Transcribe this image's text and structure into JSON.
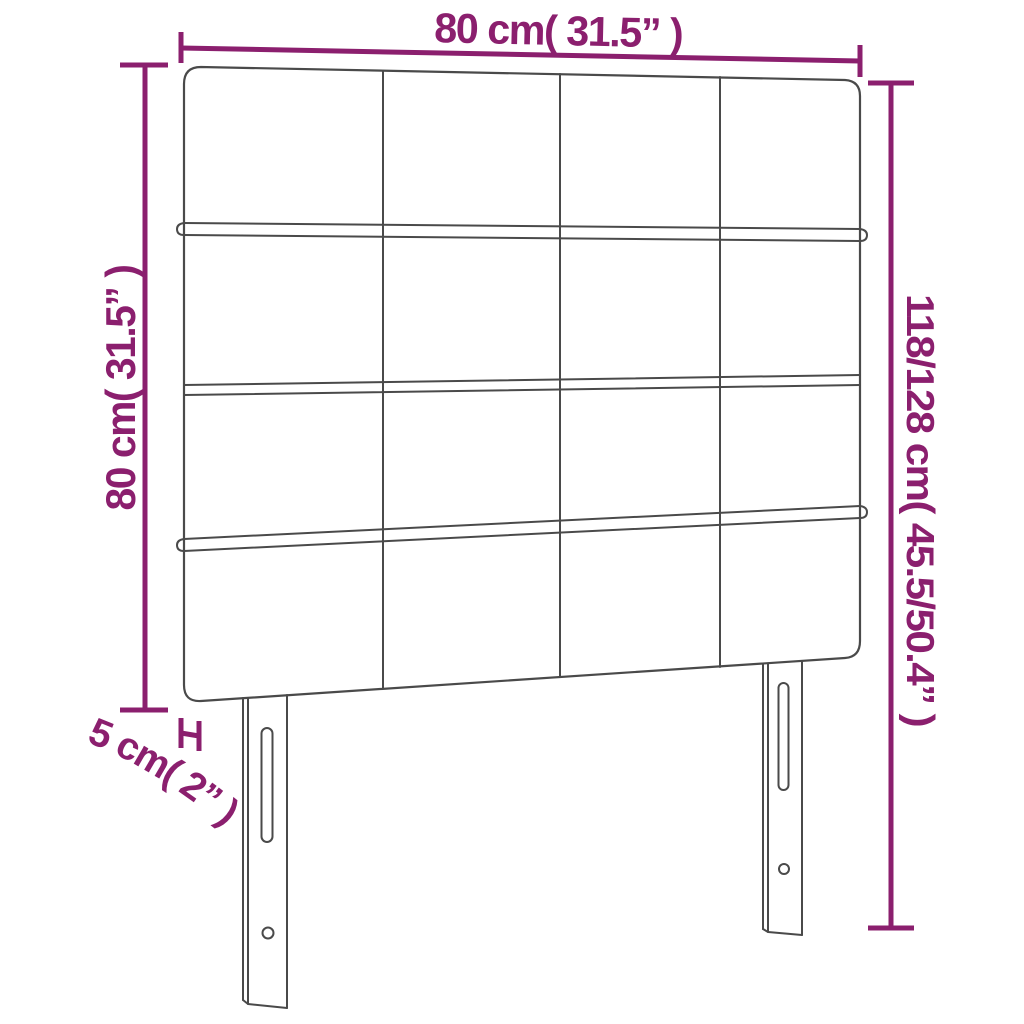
{
  "page": {
    "background": "#ffffff",
    "title": "Headboard dimension diagram"
  },
  "colors": {
    "dimension": "#8B1F6E",
    "outline": "#4A4A4A"
  },
  "product": {
    "type": "upholstered tufted headboard with legs",
    "panel_grid": {
      "rows": 4,
      "columns": 4
    },
    "legs_count": 2,
    "leg_features": [
      "height-adjustment-slot",
      "screw-hole"
    ]
  },
  "dimensions": {
    "width": {
      "label": "80 cm( 31.5” )"
    },
    "headboard_height": {
      "label": "80 cm( 31.5” )"
    },
    "total_height": {
      "label": "118/128 cm( 45.5/50.4” )"
    },
    "thickness": {
      "label": "5 cm( 2” )"
    }
  }
}
